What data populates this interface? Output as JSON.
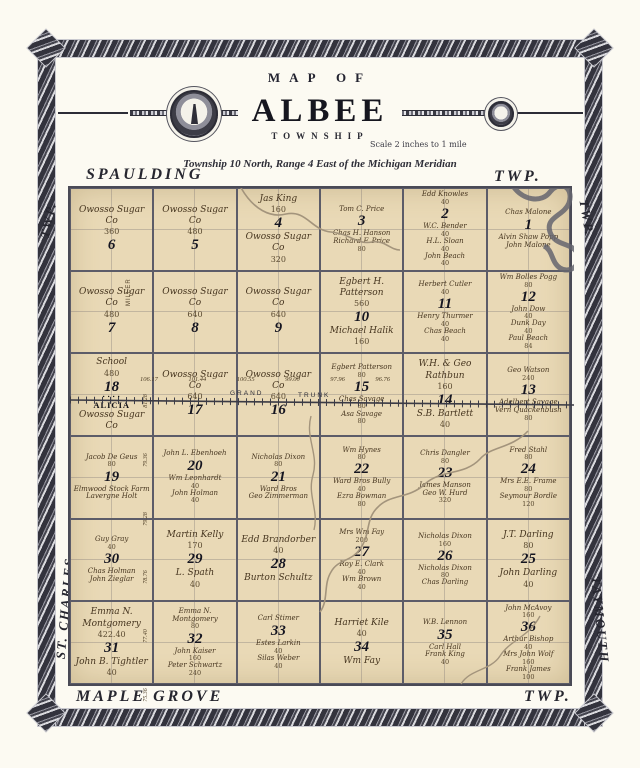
{
  "title": {
    "map_of": "MAP OF",
    "name": "ALBEE",
    "township_word": "TOWNSHIP",
    "scale": "Scale 2 inches to 1 mile",
    "subtitle": "Township 10 North, Range 4 East of the Michigan Meridian"
  },
  "edge_labels": {
    "top_left": "SPAULDING",
    "top_right": "TWP.",
    "left_top": "TWP.",
    "left_bottom": "ST. CHARLES",
    "right_top": "TWP.",
    "right_bottom": "TAYMOUTH",
    "bottom_left": "MAPLE GROVE",
    "bottom_right": "TWP."
  },
  "measures": {
    "top": [
      "106.17",
      "101.44",
      "100.55",
      "99.00",
      "97.96",
      "96.76"
    ],
    "left": [
      "81.28",
      "79.36",
      "79.28",
      "78.76",
      "77.40",
      "75.36"
    ]
  },
  "overlays": {
    "railroad": "GRAND TRUNK",
    "road": "MILLER",
    "town": "ALICIA"
  },
  "colors": {
    "paper": "#fcfaf2",
    "map_tan": "#e9d9b6",
    "ink": "#2c2c36",
    "weave": "#33333d",
    "river": "#65656f",
    "stream": "#a3947c"
  },
  "sections": [
    {
      "num": "6",
      "parcels": [
        {
          "name": "Owosso Sugar Co",
          "acres": "360"
        }
      ]
    },
    {
      "num": "5",
      "parcels": [
        {
          "name": "Owosso Sugar Co",
          "acres": "480"
        }
      ]
    },
    {
      "num": "4",
      "parcels": [
        {
          "name": "Jas King",
          "acres": "160"
        },
        {
          "name": "Owosso Sugar Co",
          "acres": "320"
        }
      ]
    },
    {
      "num": "3",
      "parcels": [
        {
          "name": "Tom C. Price",
          "acres": ""
        },
        {
          "name": "Chas H. Hanson",
          "acres": ""
        },
        {
          "name": "Richard F. Price",
          "acres": "80"
        }
      ]
    },
    {
      "num": "2",
      "parcels": [
        {
          "name": "Edd Knowles",
          "acres": "40"
        },
        {
          "name": "W.C. Bender",
          "acres": "40"
        },
        {
          "name": "H.L. Sloan",
          "acres": "40"
        },
        {
          "name": "John Beach",
          "acres": "40"
        }
      ]
    },
    {
      "num": "1",
      "parcels": [
        {
          "name": "Chas Malone",
          "acres": ""
        },
        {
          "name": "Alvin Shaw Popp",
          "acres": ""
        },
        {
          "name": "John Malone",
          "acres": ""
        }
      ]
    },
    {
      "num": "7",
      "parcels": [
        {
          "name": "Owosso Sugar Co",
          "acres": "480"
        }
      ]
    },
    {
      "num": "8",
      "parcels": [
        {
          "name": "Owosso Sugar Co",
          "acres": "640"
        }
      ]
    },
    {
      "num": "9",
      "parcels": [
        {
          "name": "Owosso Sugar Co",
          "acres": "640"
        }
      ]
    },
    {
      "num": "10",
      "parcels": [
        {
          "name": "Egbert H. Patterson",
          "acres": "560"
        },
        {
          "name": "Michael Halik",
          "acres": "160"
        }
      ]
    },
    {
      "num": "11",
      "parcels": [
        {
          "name": "Herbert Cutler",
          "acres": "40"
        },
        {
          "name": "Henry Thurmer",
          "acres": "40"
        },
        {
          "name": "Chas Beach",
          "acres": "40"
        }
      ]
    },
    {
      "num": "12",
      "parcels": [
        {
          "name": "Wm Bolles Pogg",
          "acres": "80"
        },
        {
          "name": "John Dow",
          "acres": "40"
        },
        {
          "name": "Dunk Day",
          "acres": "40"
        },
        {
          "name": "Paul Beach",
          "acres": "84"
        }
      ]
    },
    {
      "num": "18",
      "town": "ALICIA",
      "parcels": [
        {
          "name": "School",
          "acres": "480"
        },
        {
          "name": "Owosso Sugar Co",
          "acres": ""
        }
      ]
    },
    {
      "num": "17",
      "parcels": [
        {
          "name": "Owosso Sugar Co",
          "acres": "640"
        }
      ]
    },
    {
      "num": "16",
      "parcels": [
        {
          "name": "Owosso Sugar Co",
          "acres": "640"
        }
      ]
    },
    {
      "num": "15",
      "parcels": [
        {
          "name": "Egbert Patterson",
          "acres": "80"
        },
        {
          "name": "Chas Savage",
          "acres": "80"
        },
        {
          "name": "Asa Savage",
          "acres": "80"
        }
      ]
    },
    {
      "num": "14",
      "parcels": [
        {
          "name": "W.H. & Geo Rathbun",
          "acres": "160"
        },
        {
          "name": "S.B. Bartlett",
          "acres": "40"
        }
      ]
    },
    {
      "num": "13",
      "parcels": [
        {
          "name": "Geo Watson",
          "acres": "240"
        },
        {
          "name": "Adelbert Savage",
          "acres": ""
        },
        {
          "name": "Vern Quackenbush",
          "acres": "80"
        }
      ]
    },
    {
      "num": "19",
      "parcels": [
        {
          "name": "Jacob De Geus",
          "acres": "80"
        },
        {
          "name": "Elmwood Stock Farm",
          "acres": ""
        },
        {
          "name": "Lavergne Holt",
          "acres": ""
        }
      ]
    },
    {
      "num": "20",
      "parcels": [
        {
          "name": "John L. Ebenhoeh",
          "acres": ""
        },
        {
          "name": "Wm Leonhardt",
          "acres": "40"
        },
        {
          "name": "John Holman",
          "acres": "40"
        }
      ]
    },
    {
      "num": "21",
      "parcels": [
        {
          "name": "Nicholas Dixon",
          "acres": "80"
        },
        {
          "name": "Ward Bros",
          "acres": ""
        },
        {
          "name": "Geo Zimmerman",
          "acres": ""
        }
      ]
    },
    {
      "num": "22",
      "parcels": [
        {
          "name": "Wm Hynes",
          "acres": "80"
        },
        {
          "name": "Ward Bros Bully",
          "acres": "40"
        },
        {
          "name": "Ezra Bowman",
          "acres": "80"
        }
      ]
    },
    {
      "num": "23",
      "parcels": [
        {
          "name": "Chris Dangler",
          "acres": "80"
        },
        {
          "name": "James Manson",
          "acres": ""
        },
        {
          "name": "Geo W. Hurd",
          "acres": "320"
        }
      ]
    },
    {
      "num": "24",
      "parcels": [
        {
          "name": "Fred Stahl",
          "acres": "80"
        },
        {
          "name": "Mrs E.E. Frame",
          "acres": "80"
        },
        {
          "name": "Seymour Bordle",
          "acres": "120"
        }
      ]
    },
    {
      "num": "30",
      "parcels": [
        {
          "name": "Guy Gray",
          "acres": "40"
        },
        {
          "name": "Chas Holman",
          "acres": ""
        },
        {
          "name": "John Zieglar",
          "acres": ""
        }
      ]
    },
    {
      "num": "29",
      "parcels": [
        {
          "name": "Martin Kelly",
          "acres": "170"
        },
        {
          "name": "L. Spath",
          "acres": "40"
        }
      ]
    },
    {
      "num": "28",
      "parcels": [
        {
          "name": "Edd Brandorber",
          "acres": "40"
        },
        {
          "name": "Burton Schultz",
          "acres": ""
        }
      ]
    },
    {
      "num": "27",
      "parcels": [
        {
          "name": "Mrs Wm Fay",
          "acres": "200"
        },
        {
          "name": "Roy E. Clark",
          "acres": "40"
        },
        {
          "name": "Wm Brown",
          "acres": "40"
        }
      ]
    },
    {
      "num": "26",
      "parcels": [
        {
          "name": "Nicholas Dixon",
          "acres": "160"
        },
        {
          "name": "Nicholas Dixon",
          "acres": "80"
        },
        {
          "name": "Chas Darling",
          "acres": ""
        }
      ]
    },
    {
      "num": "25",
      "parcels": [
        {
          "name": "J.T. Darling",
          "acres": "80"
        },
        {
          "name": "John Darling",
          "acres": "40"
        }
      ]
    },
    {
      "num": "31",
      "parcels": [
        {
          "name": "Emma N. Montgomery",
          "acres": "422.40"
        },
        {
          "name": "John B. Tightler",
          "acres": "40"
        }
      ]
    },
    {
      "num": "32",
      "parcels": [
        {
          "name": "Emma N. Montgomery",
          "acres": "80"
        },
        {
          "name": "John Kaiser",
          "acres": "160"
        },
        {
          "name": "Peter Schwartz",
          "acres": "240"
        }
      ]
    },
    {
      "num": "33",
      "parcels": [
        {
          "name": "Carl Stimer",
          "acres": ""
        },
        {
          "name": "Estes Larkin",
          "acres": "40"
        },
        {
          "name": "Silas Weber",
          "acres": "40"
        }
      ]
    },
    {
      "num": "34",
      "parcels": [
        {
          "name": "Harriet Kile",
          "acres": "40"
        },
        {
          "name": "Wm Fay",
          "acres": ""
        }
      ]
    },
    {
      "num": "35",
      "parcels": [
        {
          "name": "W.B. Lennon",
          "acres": ""
        },
        {
          "name": "Carl Hall",
          "acres": ""
        },
        {
          "name": "Frank King",
          "acres": "40"
        }
      ]
    },
    {
      "num": "36",
      "parcels": [
        {
          "name": "John McAvoy",
          "acres": "160"
        },
        {
          "name": "Arthur Bishop",
          "acres": "40"
        },
        {
          "name": "Mrs John Wolf",
          "acres": "160"
        },
        {
          "name": "Frank James",
          "acres": "100"
        }
      ]
    }
  ]
}
